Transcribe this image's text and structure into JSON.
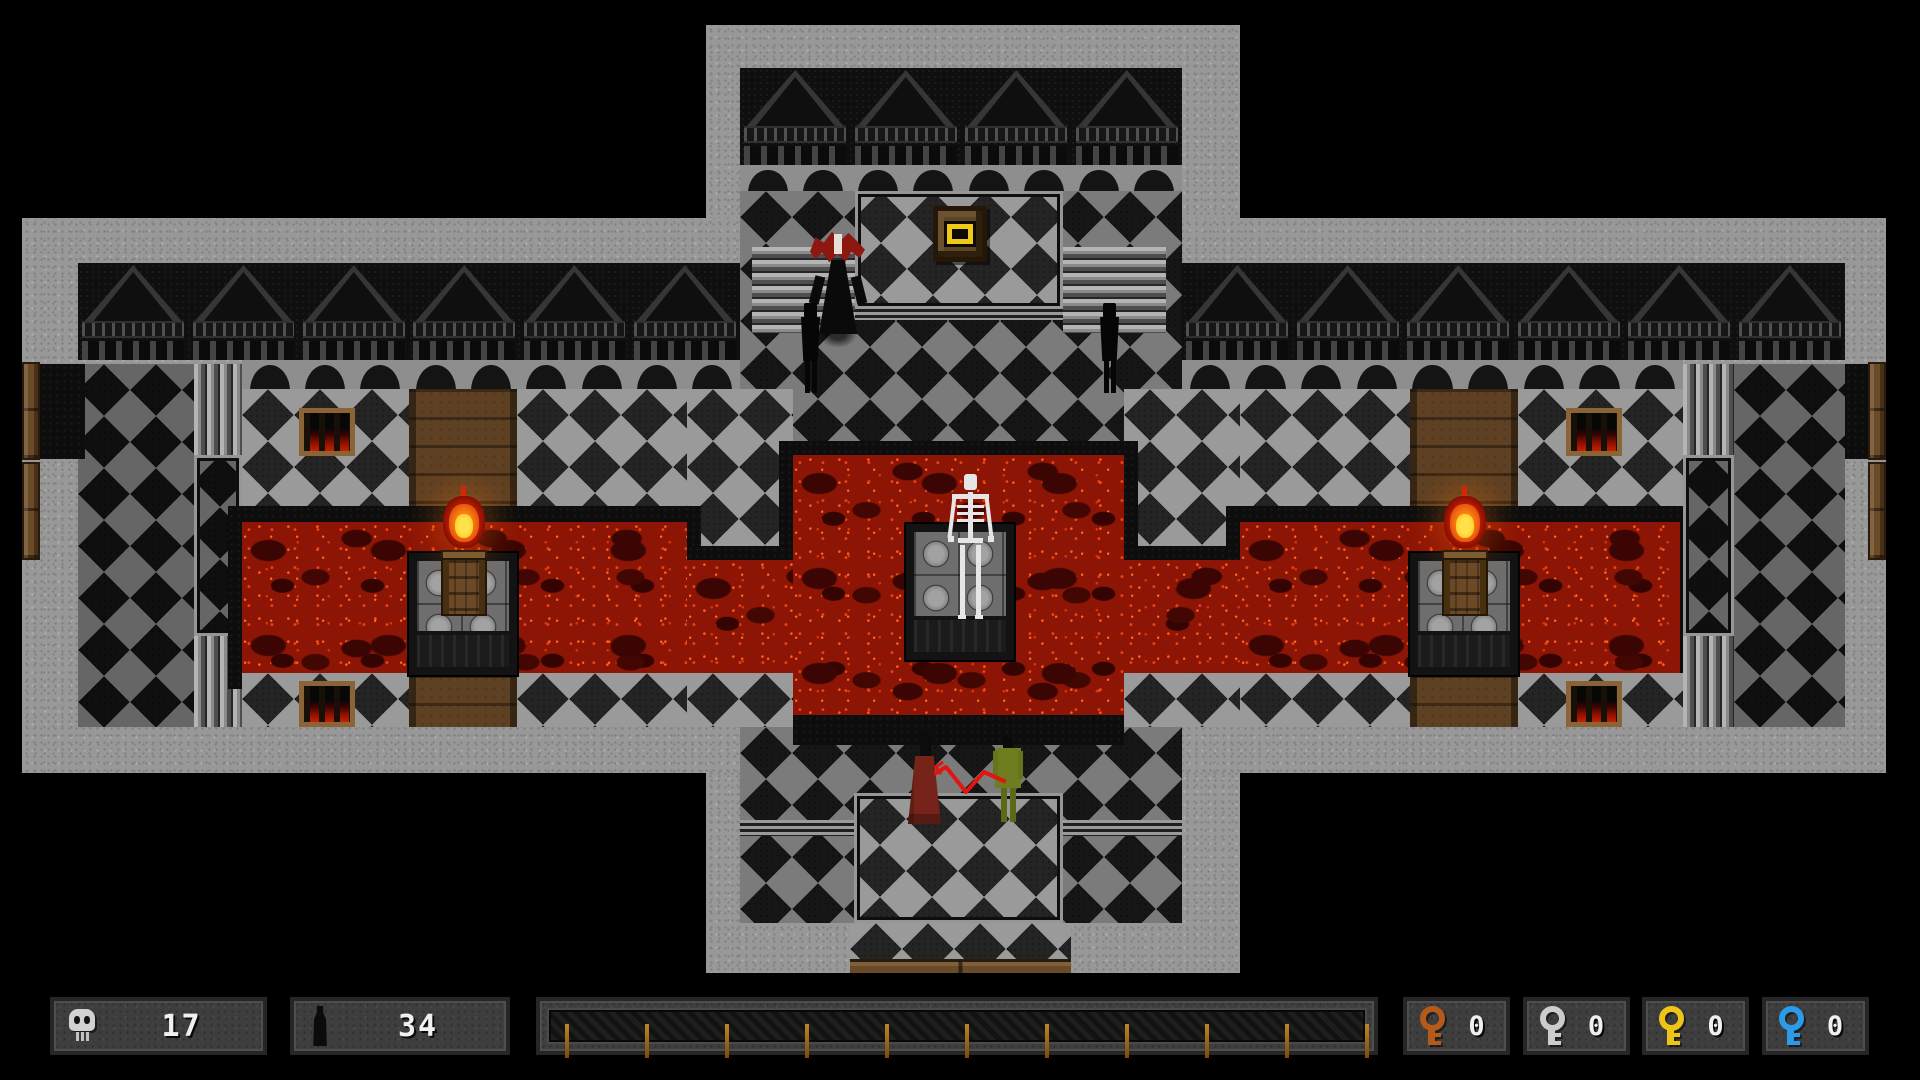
{
  "hud": {
    "skull_count": "17",
    "bottle_count": "34",
    "progress_bar": {
      "tick_count": 11,
      "tick_color": "#c08426"
    },
    "keys": [
      {
        "name": "copper-key",
        "color": "#b45a1a",
        "count": "0"
      },
      {
        "name": "silver-key",
        "color": "#cccccc",
        "count": "0"
      },
      {
        "name": "gold-key",
        "color": "#eec419",
        "count": "0"
      },
      {
        "name": "blue-key",
        "color": "#2b9ae8",
        "count": "0"
      }
    ]
  },
  "colors": {
    "stone": "#989898",
    "dark_wall": "#0f0f0f",
    "lava": "#8c1505",
    "wood": "#6b4a26",
    "gold_item": "#f0c818",
    "whip": "#e01410"
  },
  "map": {
    "regions": [
      {
        "name": "vertical-arm",
        "type": "stone",
        "x": 706,
        "y": 25,
        "w": 534,
        "h": 948
      },
      {
        "name": "horizontal-arm",
        "type": "stone",
        "x": 22,
        "y": 218,
        "w": 1864,
        "h": 555
      },
      {
        "name": "top-wall",
        "type": "gableband",
        "x": 740,
        "y": 68,
        "w": 442,
        "h": 97,
        "gables": 4
      },
      {
        "name": "top-arches",
        "type": "archrow",
        "x": 740,
        "y": 165,
        "w": 442,
        "h": 26,
        "arches": 8
      },
      {
        "name": "top-arm-floor",
        "type": "tiles tiles-mid",
        "x": 740,
        "y": 191,
        "w": 442,
        "h": 264
      },
      {
        "name": "upper-platform",
        "type": "tiles tiles-light frame",
        "x": 855,
        "y": 191,
        "w": 208,
        "h": 118
      },
      {
        "name": "upper-platform-edge",
        "type": "ledge",
        "x": 855,
        "y": 306,
        "w": 208,
        "h": 14
      },
      {
        "name": "stairs-upper-left",
        "type": "stairs-h",
        "x": 752,
        "y": 247,
        "w": 103,
        "h": 86
      },
      {
        "name": "stairs-upper-right",
        "type": "stairs-h",
        "x": 1063,
        "y": 247,
        "w": 103,
        "h": 86
      },
      {
        "name": "left-wall",
        "type": "gableband",
        "x": 78,
        "y": 263,
        "w": 662,
        "h": 97,
        "gables": 6
      },
      {
        "name": "right-wall",
        "type": "gableband",
        "x": 1182,
        "y": 263,
        "w": 663,
        "h": 97,
        "gables": 6
      },
      {
        "name": "left-arches",
        "type": "archrow",
        "x": 242,
        "y": 360,
        "w": 498,
        "h": 29,
        "arches": 9
      },
      {
        "name": "right-arches",
        "type": "archrow",
        "x": 1182,
        "y": 360,
        "w": 501,
        "h": 29,
        "arches": 9
      },
      {
        "name": "left-upper-floor",
        "type": "tiles tiles-dark",
        "x": 78,
        "y": 364,
        "w": 116,
        "h": 363
      },
      {
        "name": "left-stair-column",
        "type": "tiles tiles-dark frame",
        "x": 194,
        "y": 455,
        "w": 48,
        "h": 181
      },
      {
        "name": "left-stairs-top",
        "type": "stairs-v",
        "x": 194,
        "y": 364,
        "w": 48,
        "h": 91
      },
      {
        "name": "left-stairs-bottom",
        "type": "stairs-v",
        "x": 194,
        "y": 636,
        "w": 48,
        "h": 91
      },
      {
        "name": "left-door-niche",
        "type": "darkfill",
        "x": 40,
        "y": 364,
        "w": 45,
        "h": 95
      },
      {
        "name": "left-door-upper",
        "type": "door",
        "x": 22,
        "y": 362,
        "w": 18,
        "h": 98
      },
      {
        "name": "left-door-lower",
        "type": "door",
        "x": 22,
        "y": 462,
        "w": 18,
        "h": 98
      },
      {
        "name": "left-shore-a",
        "type": "tiles tiles-light",
        "x": 242,
        "y": 389,
        "w": 167,
        "h": 133
      },
      {
        "name": "left-corridor-top",
        "type": "wood",
        "x": 409,
        "y": 389,
        "w": 108,
        "h": 133
      },
      {
        "name": "left-shore-b",
        "type": "tiles tiles-light",
        "x": 517,
        "y": 389,
        "w": 170,
        "h": 133
      },
      {
        "name": "left-peninsula",
        "type": "tiles tiles-light",
        "x": 687,
        "y": 389,
        "w": 106,
        "h": 171
      },
      {
        "name": "right-peninsula",
        "type": "tiles tiles-light",
        "x": 1124,
        "y": 389,
        "w": 116,
        "h": 171
      },
      {
        "name": "right-shore-a",
        "type": "tiles tiles-light",
        "x": 1240,
        "y": 389,
        "w": 170,
        "h": 133
      },
      {
        "name": "right-corridor-top",
        "type": "wood",
        "x": 1410,
        "y": 389,
        "w": 108,
        "h": 133
      },
      {
        "name": "right-shore-b",
        "type": "tiles tiles-light",
        "x": 1518,
        "y": 389,
        "w": 165,
        "h": 133
      },
      {
        "name": "lava-shadow-left",
        "type": "darkfill",
        "x": 228,
        "y": 506,
        "w": 473,
        "h": 183
      },
      {
        "name": "lava-shadow-center",
        "type": "darkfill",
        "x": 673,
        "y": 546,
        "w": 581,
        "h": 141
      },
      {
        "name": "lava-shadow-pool",
        "type": "darkfill",
        "x": 779,
        "y": 441,
        "w": 359,
        "h": 291
      },
      {
        "name": "lava-shadow-right",
        "type": "darkfill",
        "x": 1226,
        "y": 506,
        "w": 468,
        "h": 183
      },
      {
        "name": "lava-left",
        "type": "lava",
        "x": 242,
        "y": 522,
        "w": 445,
        "h": 151
      },
      {
        "name": "lava-center",
        "type": "lava",
        "x": 687,
        "y": 560,
        "w": 553,
        "h": 113
      },
      {
        "name": "lava-pool",
        "type": "lava",
        "x": 793,
        "y": 455,
        "w": 331,
        "h": 263
      },
      {
        "name": "lava-right",
        "type": "lava",
        "x": 1240,
        "y": 522,
        "w": 440,
        "h": 151
      },
      {
        "name": "left-shore-bottom-a",
        "type": "tiles tiles-light",
        "x": 242,
        "y": 673,
        "w": 167,
        "h": 54
      },
      {
        "name": "left-corridor-bottom",
        "type": "wood",
        "x": 409,
        "y": 675,
        "w": 108,
        "h": 52
      },
      {
        "name": "left-shore-bottom-b",
        "type": "tiles tiles-light",
        "x": 517,
        "y": 673,
        "w": 170,
        "h": 54
      },
      {
        "name": "center-shore-bottom-left",
        "type": "tiles tiles-light",
        "x": 687,
        "y": 673,
        "w": 106,
        "h": 54
      },
      {
        "name": "center-shore-bottom-right",
        "type": "tiles tiles-light",
        "x": 1124,
        "y": 673,
        "w": 116,
        "h": 54
      },
      {
        "name": "right-shore-bottom-a",
        "type": "tiles tiles-light",
        "x": 1240,
        "y": 673,
        "w": 170,
        "h": 54
      },
      {
        "name": "right-corridor-bottom",
        "type": "wood",
        "x": 1410,
        "y": 675,
        "w": 108,
        "h": 52
      },
      {
        "name": "right-shore-bottom-b",
        "type": "tiles tiles-light",
        "x": 1518,
        "y": 673,
        "w": 165,
        "h": 54
      },
      {
        "name": "right-stair-column",
        "type": "tiles tiles-dark frame",
        "x": 1683,
        "y": 455,
        "w": 51,
        "h": 181
      },
      {
        "name": "right-stairs-top",
        "type": "stairs-v",
        "x": 1683,
        "y": 364,
        "w": 51,
        "h": 91
      },
      {
        "name": "right-stairs-bottom",
        "type": "stairs-v",
        "x": 1683,
        "y": 636,
        "w": 51,
        "h": 91
      },
      {
        "name": "right-upper-floor",
        "type": "tiles tiles-dark",
        "x": 1734,
        "y": 364,
        "w": 111,
        "h": 363
      },
      {
        "name": "right-door-niche",
        "type": "darkfill",
        "x": 1845,
        "y": 364,
        "w": 41,
        "h": 95
      },
      {
        "name": "right-door-upper",
        "type": "door",
        "x": 1868,
        "y": 362,
        "w": 18,
        "h": 98
      },
      {
        "name": "right-door-lower",
        "type": "door",
        "x": 1868,
        "y": 462,
        "w": 18,
        "h": 98
      },
      {
        "name": "grate-top-left",
        "type": "grate",
        "x": 299,
        "y": 408,
        "w": 56,
        "h": 48
      },
      {
        "name": "grate-bottom-left",
        "type": "grate",
        "x": 299,
        "y": 681,
        "w": 56,
        "h": 46
      },
      {
        "name": "grate-top-right",
        "type": "grate",
        "x": 1566,
        "y": 408,
        "w": 56,
        "h": 48
      },
      {
        "name": "grate-bottom-right",
        "type": "grate",
        "x": 1566,
        "y": 681,
        "w": 56,
        "h": 46
      },
      {
        "name": "left-brazier-platform",
        "type": "platform",
        "x": 409,
        "y": 553,
        "w": 108,
        "h": 122
      },
      {
        "name": "right-brazier-platform",
        "type": "platform",
        "x": 1410,
        "y": 553,
        "w": 108,
        "h": 122
      },
      {
        "name": "center-platform",
        "type": "platform",
        "x": 906,
        "y": 524,
        "w": 108,
        "h": 136
      },
      {
        "name": "bottom-arm-floor",
        "type": "tiles tiles-mid",
        "x": 740,
        "y": 727,
        "w": 442,
        "h": 196
      },
      {
        "name": "pool-south-shore",
        "type": "darkfill",
        "x": 793,
        "y": 715,
        "w": 331,
        "h": 30
      },
      {
        "name": "bottom-ledge-left",
        "type": "ledge",
        "x": 740,
        "y": 820,
        "w": 114,
        "h": 16
      },
      {
        "name": "bottom-ledge-right",
        "type": "ledge",
        "x": 1063,
        "y": 820,
        "w": 119,
        "h": 16
      },
      {
        "name": "bottom-passage",
        "type": "tiles tiles-light frame",
        "x": 854,
        "y": 793,
        "w": 209,
        "h": 130
      },
      {
        "name": "bottom-passage-lower",
        "type": "tiles tiles-light",
        "x": 850,
        "y": 923,
        "w": 221,
        "h": 36
      },
      {
        "name": "bottom-door",
        "type": "door-h",
        "x": 850,
        "y": 959,
        "w": 221,
        "h": 14
      },
      {
        "name": "pedestal",
        "type": "pedestal",
        "x": 933,
        "y": 206,
        "w": 54,
        "h": 56
      }
    ],
    "entities": [
      {
        "name": "left-brazier",
        "type": "brazier",
        "x": 441,
        "y": 496
      },
      {
        "name": "right-brazier",
        "type": "brazier",
        "x": 1442,
        "y": 496
      },
      {
        "name": "skeleton",
        "type": "skeleton",
        "x": 946,
        "y": 474
      },
      {
        "name": "vampire",
        "type": "vampire",
        "x": 810,
        "y": 230
      },
      {
        "name": "shadow-figure-left",
        "type": "shadow",
        "x": 797,
        "y": 303
      },
      {
        "name": "shadow-figure-right",
        "type": "shadow",
        "x": 1096,
        "y": 303
      },
      {
        "name": "red-robed-figure",
        "type": "red-figure",
        "x": 908,
        "y": 732
      },
      {
        "name": "green-figure",
        "type": "green-figure",
        "x": 993,
        "y": 737
      },
      {
        "name": "whip",
        "type": "whip",
        "x": 925,
        "y": 752
      }
    ]
  }
}
